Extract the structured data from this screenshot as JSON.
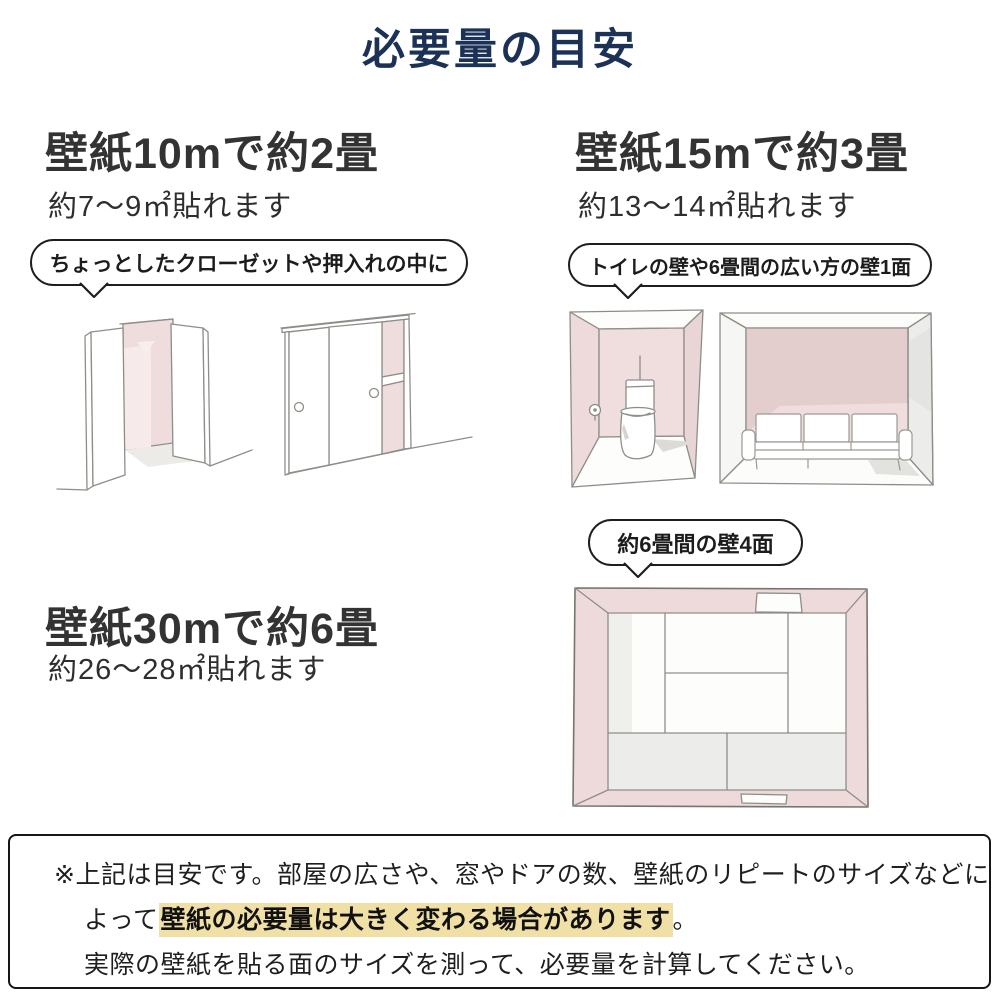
{
  "title": "必要量の目安",
  "colors": {
    "title_navy": "#1b3156",
    "heading_gray": "#333333",
    "wall_pink": "#f0dede",
    "wall_pink_dark": "#e3cdcd",
    "highlight_yellow": "#f1e0a6",
    "sketch_line": "#8e8e88"
  },
  "sections": {
    "roll10": {
      "heading": "壁紙10mで約2畳",
      "subheading": "約7〜9㎡貼れます",
      "bubble": "ちょっとしたクローゼットや押入れの中に"
    },
    "roll15": {
      "heading": "壁紙15mで約3畳",
      "subheading": "約13〜14㎡貼れます",
      "bubble": "トイレの壁や6畳間の広い方の壁1面"
    },
    "roll30": {
      "heading": "壁紙30mで約6畳",
      "subheading": "約26〜28㎡貼れます",
      "bubble": "約6畳間の壁4面"
    }
  },
  "notes": {
    "line1": "※上記は目安です。部屋の広さや、窓やドアの数、壁紙のリピートのサイズなどに",
    "line2_prefix": "よって",
    "line2_highlight": "壁紙の必要量は大きく変わる場合があります",
    "line2_suffix": "。",
    "line3": "実際の壁紙を貼る面のサイズを測って、必要量を計算してください。"
  }
}
